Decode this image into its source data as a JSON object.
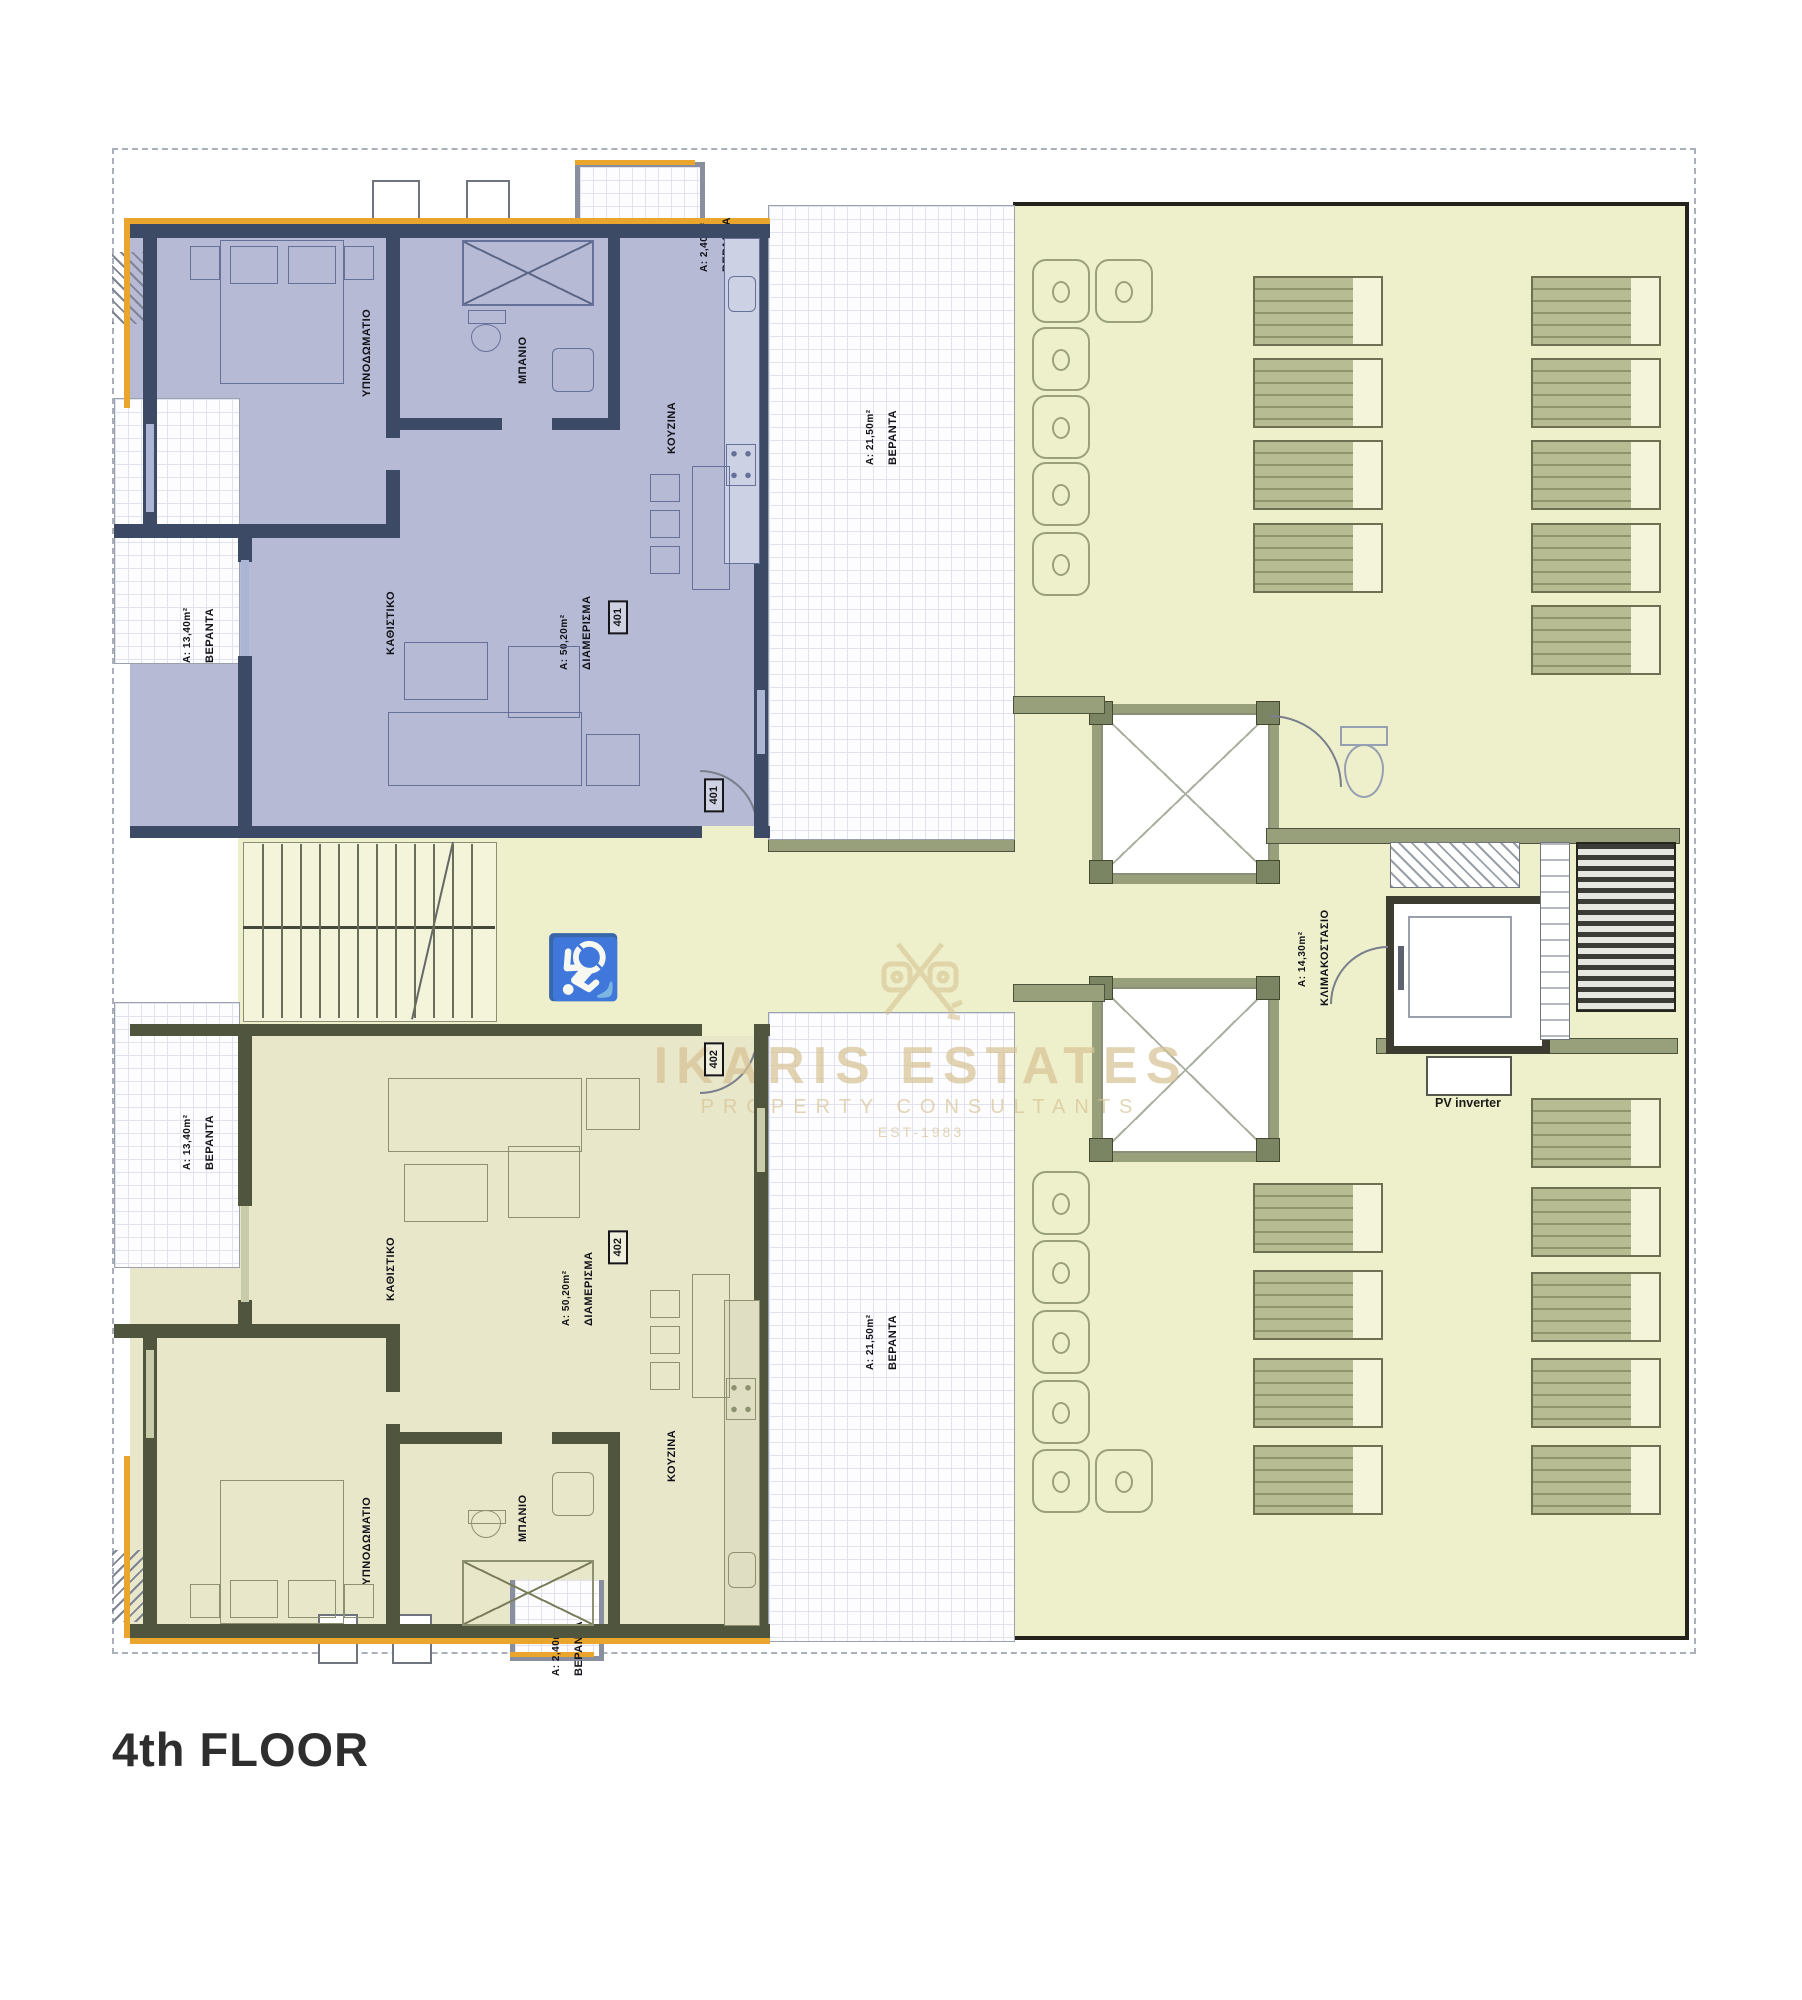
{
  "title": "4th FLOOR",
  "watermark": {
    "name": "IKARIS ESTATES",
    "tagline": "PROPERTY CONSULTANTS",
    "est": "EST-1983"
  },
  "labels": {
    "bedroom": "ΥΠΝΟΔΩΜΑΤΙΟ",
    "bathroom": "ΜΠΑΝΙΟ",
    "kitchen": "ΚΟΥΖΙΝΑ",
    "living": "ΚΑΘΙΣΤΙΚΟ",
    "apartment": "ΔΙΑΜΕΡΙΣΜΑ",
    "veranda": "ΒΕΡΑΝΤΑ",
    "stairwell": "ΚΛΙΜΑΚΟΣΤΑΣΙΟ",
    "pv_inverter": "PV inverter"
  },
  "apartment_401": {
    "number": "401",
    "area": "Α: 50,20m²",
    "veranda_area": "Α: 13,40m²",
    "terrace_area": "Α: 21,50m²",
    "small_veranda_area": "Α: 2,40m²"
  },
  "apartment_402": {
    "number": "402",
    "area": "Α: 50,20m²",
    "veranda_area": "Α: 13,40m²",
    "terrace_area": "Α: 21,50m²",
    "small_veranda_area": "Α: 2,40m²"
  },
  "core": {
    "stairwell_area": "Α: 14,30m²"
  },
  "colors": {
    "apartment_401_fill": "#b6bad5",
    "apartment_402_fill": "#e9e7ca",
    "terrace_fill": "#eef0cc",
    "accent": "#eaa62c"
  }
}
